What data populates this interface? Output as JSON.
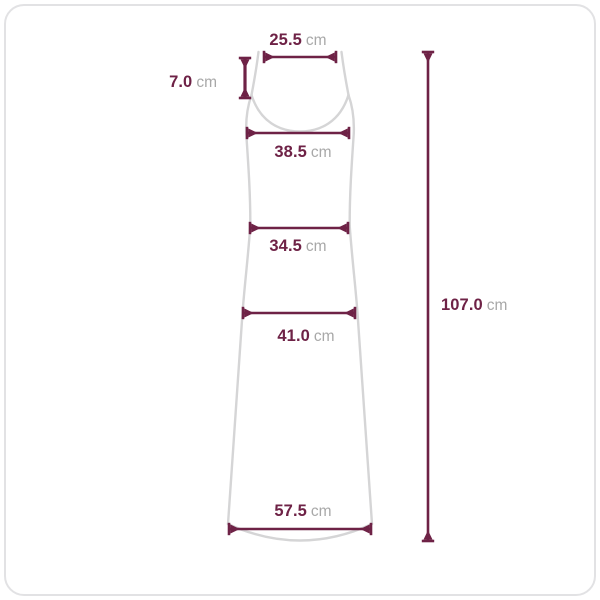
{
  "diagram": {
    "subject": "sleeveless-maxi-dress-size-diagram",
    "unit": "cm",
    "colors": {
      "measure_line": "#6e2246",
      "value_text": "#6e2246",
      "unit_text": "#a8a8a8",
      "garment_outline": "#d5d5d6",
      "frame_border": "#e2e2e4",
      "background": "#ffffff"
    },
    "measurements": [
      {
        "id": "shoulder-width",
        "value": "25.5",
        "unit": "cm"
      },
      {
        "id": "strap-length",
        "value": "7.0",
        "unit": "cm"
      },
      {
        "id": "bust-width",
        "value": "38.5",
        "unit": "cm"
      },
      {
        "id": "waist-width",
        "value": "34.5",
        "unit": "cm"
      },
      {
        "id": "hip-width",
        "value": "41.0",
        "unit": "cm"
      },
      {
        "id": "total-length",
        "value": "107.0",
        "unit": "cm"
      },
      {
        "id": "hem-width",
        "value": "57.5",
        "unit": "cm"
      }
    ]
  }
}
